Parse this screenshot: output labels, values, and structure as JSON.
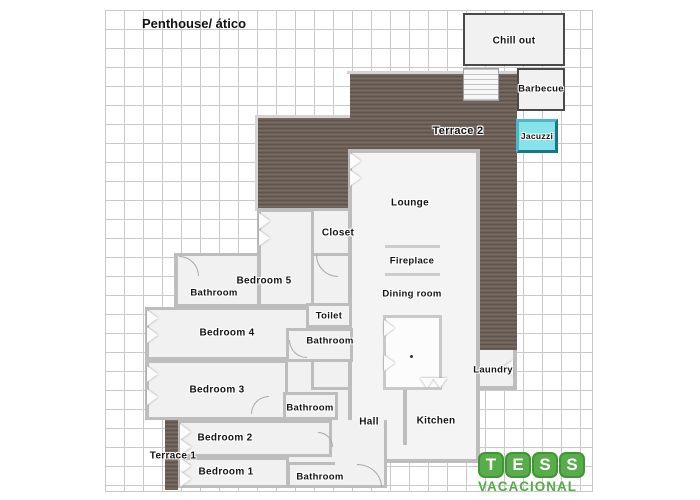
{
  "title": "Penthouse/ ático",
  "rooms": {
    "chill_out": "Chill out",
    "barbecue": "Barbecue",
    "jacuzzi": "Jacuzzi",
    "terrace2": "Terrace 2",
    "lounge": "Lounge",
    "closet": "Closet",
    "fireplace": "Fireplace",
    "dining_room": "Dining room",
    "bedroom5": "Bedroom 5",
    "bedroom4": "Bedroom 4",
    "bedroom3": "Bedroom 3",
    "bedroom2": "Bedroom 2",
    "bedroom1": "Bedroom 1",
    "bathroom": "Bathroom",
    "toilet": "Toilet",
    "hall": "Hall",
    "kitchen": "Kitchen",
    "laundry": "Laundry",
    "terrace1": "Terrace 1"
  },
  "logo": {
    "letters": [
      "T",
      "E",
      "S",
      "S"
    ],
    "word": "VACACIONAL"
  },
  "colors": {
    "deck_brown": "#6d6058",
    "jacuzzi_cyan": "#85e3e9",
    "logo_green": "#55ac47",
    "wall_gray": "#bdbdbd",
    "grid_gray": "#c9c9c9",
    "dark_outline": "#4a4a4a"
  }
}
